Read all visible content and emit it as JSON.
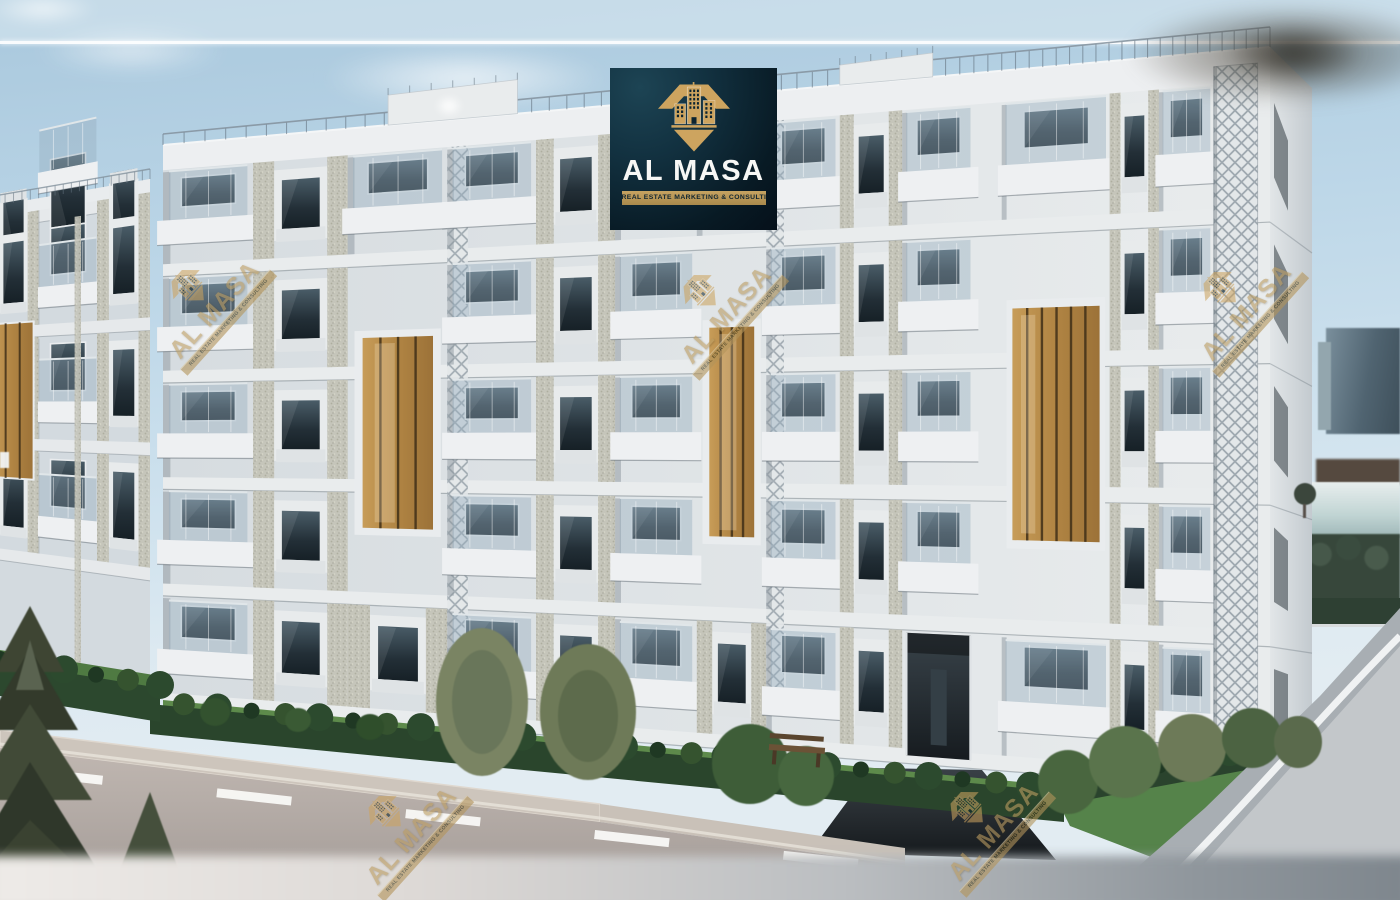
{
  "scene": {
    "type": "architectural-exterior-render",
    "sky_color": "#bcd5e6",
    "facade_color": "#e7eaec",
    "wood_accent_color": "#b5884b",
    "vegetation_color": "#3d5c38",
    "road_color": "#b2a8a3",
    "divider_line_color": "#ffffff"
  },
  "logo_overlay": {
    "brand": "AL MASA",
    "tagline": "REAL ESTATE MARKETING & CONSULTING",
    "background_color": "#0e3140",
    "gold_color": "#cda45f",
    "brand_text_color": "#f7f7f5",
    "icon": "diamond-buildings-icon"
  },
  "watermark": {
    "brand": "AL MASA",
    "tagline": "REAL ESTATE MARKETING & CONSULTING",
    "color": "#b5965a",
    "count": 5,
    "icon": "diamond-buildings-icon"
  }
}
